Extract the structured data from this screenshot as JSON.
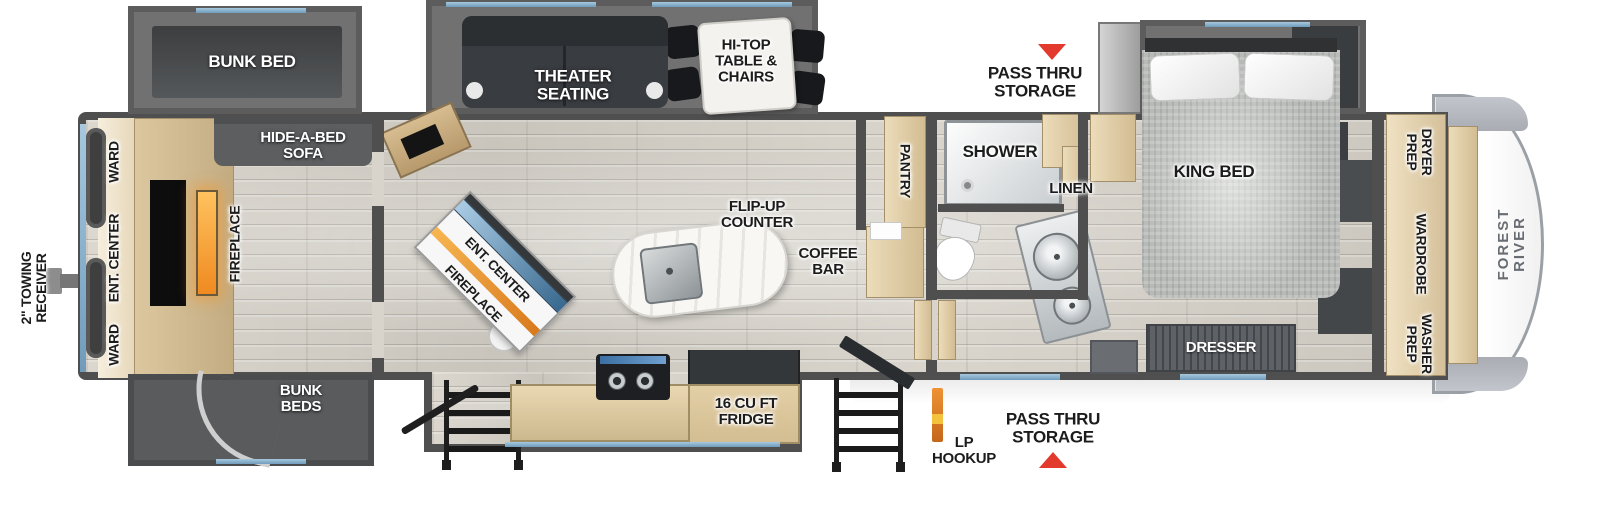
{
  "brand": {
    "name": "FOREST RIVER"
  },
  "exterior": {
    "towing_receiver": "2\" TOWING\nRECEIVER",
    "pass_thru_top": "PASS THRU\nSTORAGE",
    "pass_thru_bottom": "PASS THRU\nSTORAGE",
    "lp_hookup": "LP\nHOOKUP"
  },
  "rear_room": {
    "bunk_bed": "BUNK BED",
    "bunk_beds": "BUNK\nBEDS",
    "ward_top": "WARD",
    "ent_center": "ENT. CENTER",
    "ward_bottom": "WARD",
    "fireplace": "FIREPLACE",
    "hide_a_bed": "HIDE-A-BED\nSOFA"
  },
  "living": {
    "theater_seating": "THEATER\nSEATING",
    "hi_top": "HI-TOP\nTABLE &\nCHAIRS",
    "flip_up_counter": "FLIP-UP\nCOUNTER",
    "ent_center": "ENT. CENTER",
    "fireplace": "FIREPLACE",
    "coffee_bar": "COFFEE\nBAR"
  },
  "kitchen": {
    "fridge": "16 CU FT\nFRIDGE",
    "pantry": "PANTRY"
  },
  "bath": {
    "shower": "SHOWER",
    "linen": "LINEN"
  },
  "bedroom": {
    "king_bed": "KING BED",
    "dresser": "DRESSER"
  },
  "closet": {
    "dryer_prep": "DRYER\nPREP",
    "wardrobe": "WARDROBE",
    "washer_prep": "WASHER\nPREP"
  },
  "colors": {
    "accent_blue": "#7fa9c7",
    "alert_red": "#e23b2e",
    "cabinet_tan": "#dcc69e",
    "wall_gray": "#4f4f4f",
    "fireplace_orange": "#f09a3e",
    "floor_wood": "#d6d2ca"
  }
}
